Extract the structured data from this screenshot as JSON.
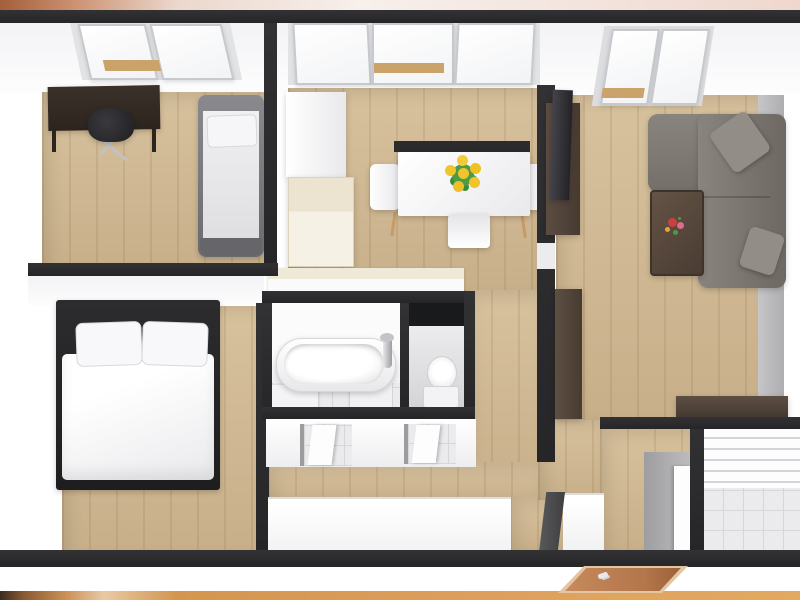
{
  "app": {
    "type": "3d-floor-plan-render",
    "title": "Apartment 3D floor plan (top-down render)"
  },
  "palette": {
    "wall_dark": "#323234",
    "wall_darker": "#262628",
    "wall_gray": "#aeaeb1",
    "floor_wood": "#d3ba92",
    "floor_tile": "#ebebed",
    "cream": "#ece3d0",
    "sofa_gray": "#7f7974",
    "furniture_brown": "#55463a",
    "desk_brown": "#342b24",
    "frame_dark": "#26262a",
    "door_copper": "#bd8055",
    "sunflower_yellow": "#f1c42c",
    "leaf_green": "#4f9a43",
    "bar_top_left": "#a35f3a",
    "bar_top_mid": "#f2e4da",
    "bar_top_right": "#efd7cd",
    "bar_bottom_left": "#3a2a20",
    "bar_bottom_light": "#e9c9a4",
    "bar_bottom_main": "#dda05c"
  },
  "scene": {
    "border_top": "copper-to-pink gradient bar",
    "border_bottom": "copper/orange gradient bar",
    "windows_total_skylight_panes": 7,
    "rooms": [
      {
        "id": "office",
        "label": "office / small bedroom",
        "furniture": [
          "dark desk",
          "office chair",
          "single bed"
        ],
        "windows": [
          "2-pane skylight"
        ]
      },
      {
        "id": "kitchen-dining",
        "label": "kitchen & dining",
        "furniture": [
          "tall white cabinet",
          "cream refrigerator unit",
          "kitchen counter",
          "white dining table",
          "3 white chairs",
          "sunflower bouquet"
        ],
        "windows": [
          "3-pane skylight"
        ]
      },
      {
        "id": "living-room",
        "label": "living room",
        "furniture": [
          "wall TV",
          "dark TV cabinet",
          "gray corner sofa",
          "2 sofa cushions",
          "brown coffee table",
          "flower pot",
          "brown sideboard",
          "brown console counter"
        ],
        "windows": [
          "2-pane skylight"
        ]
      },
      {
        "id": "bedroom",
        "label": "master bedroom",
        "furniture": [
          "double bed with dark frame",
          "2 white pillows",
          "white duvet"
        ]
      },
      {
        "id": "bathroom",
        "label": "bathroom",
        "furniture": [
          "bathtub",
          "chrome faucet",
          "white vanity blocks"
        ]
      },
      {
        "id": "wc",
        "label": "separate WC",
        "furniture": [
          "toilet"
        ]
      },
      {
        "id": "hallway",
        "label": "hallway with two bathroom doors",
        "furniture": []
      },
      {
        "id": "entry",
        "label": "entry",
        "furniture": [
          "copper front door with handle"
        ]
      },
      {
        "id": "utility",
        "label": "tiled utility / balcony room",
        "furniture": []
      }
    ]
  }
}
